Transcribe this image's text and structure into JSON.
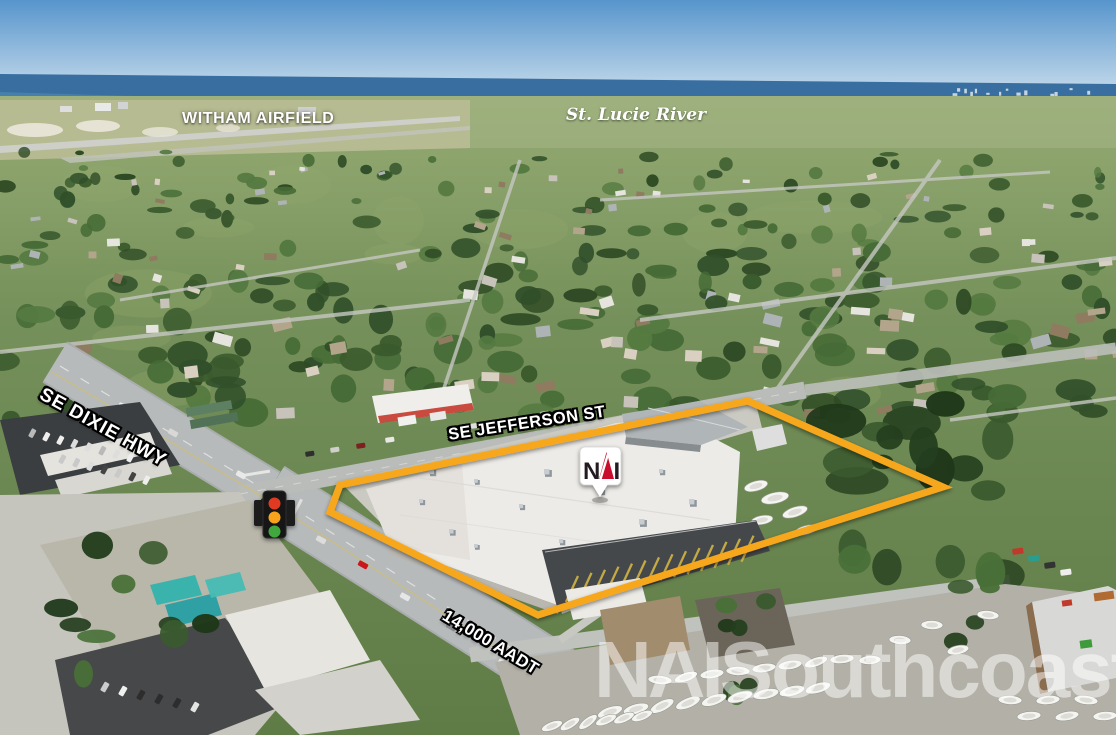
{
  "annotations": {
    "airfield_label": "WITHAM AIRFIELD",
    "river_label": "St. Lucie River",
    "dixie_hwy_label": "SE DIXIE HWY",
    "jefferson_st_label": "SE JEFFERSON ST",
    "traffic_count_label": "14,000 AADT"
  },
  "marker": {
    "logo_n": "N",
    "logo_i": "I"
  },
  "watermark": {
    "brand": "NAI",
    "name": "Southcoast"
  },
  "colors": {
    "property_outline": "#F7A71B",
    "logo_red": "#C8102E",
    "logo_dark": "#231F20",
    "signal_red": "#E03A24",
    "signal_amber": "#F6A21D",
    "signal_green": "#3FA83C"
  }
}
